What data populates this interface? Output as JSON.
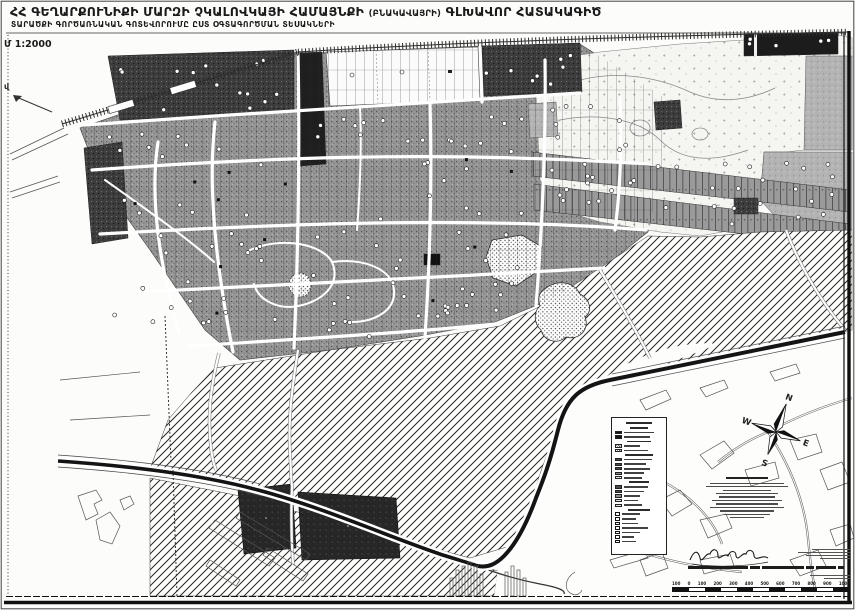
{
  "sheet": {
    "title_main": "ՀՀ ԳԵՂԱՐՔՈՒՆԻՔԻ ՄԱՐԶԻ ՉԿԱԼՈՎԿԱՅԻ ՀԱՄԱՅՆՔԻ",
    "title_paren": "(ԲՆԱԿԱՎԱՅՐԻ)",
    "title_tail": "ԳԼԽԱՎՈՐ ՀԱՏԱԿԱԳԻԾ",
    "subtitle": "ՏԱՐԱԾՔԻ ԳՈՐԾԱՌՆԱԿԱՆ ԳՈՏԵՎՈՐՈՒՄԸ ԸՍՏ ՕԳՏԱԳՈՐԾՄԱՆ ՏԵՍԱԿՆԵՐԻ",
    "scale_note": "Մ 1:2000",
    "edge_marker": "վ"
  },
  "compass": {
    "north": "N",
    "east": "E",
    "south": "S",
    "west": "W"
  },
  "legend": {
    "items": [
      {
        "k": "head",
        "lw": 26
      },
      {
        "k": "head",
        "lw": 18
      },
      {
        "k": "row",
        "s": "black",
        "lw": 30
      },
      {
        "k": "row",
        "s": "black",
        "lw": 26
      },
      {
        "k": "head",
        "lw": 24
      },
      {
        "k": "row",
        "s": "hatch",
        "lw": 16
      },
      {
        "k": "row",
        "s": "hatch",
        "lw": 24
      },
      {
        "k": "head",
        "lw": 28
      },
      {
        "k": "row",
        "s": "dark",
        "lw": 28
      },
      {
        "k": "row",
        "s": "dark",
        "lw": 22
      },
      {
        "k": "row",
        "s": "dark",
        "lw": 26
      },
      {
        "k": "row",
        "s": "gray",
        "lw": 20
      },
      {
        "k": "row",
        "s": "dots",
        "lw": 18
      },
      {
        "k": "head",
        "lw": 20
      },
      {
        "k": "row",
        "s": "dark",
        "lw": 24
      },
      {
        "k": "row",
        "s": "dark",
        "lw": 20
      },
      {
        "k": "row",
        "s": "gray",
        "lw": 16
      },
      {
        "k": "row",
        "s": "light",
        "lw": 14
      },
      {
        "k": "row",
        "s": "light",
        "lw": 18
      },
      {
        "k": "head",
        "lw": 22
      },
      {
        "k": "icon",
        "lw": 18
      },
      {
        "k": "icon",
        "lw": 14
      },
      {
        "k": "icon",
        "lw": 16
      },
      {
        "k": "icon",
        "lw": 26
      },
      {
        "k": "icon",
        "lw": 18
      },
      {
        "k": "icon",
        "lw": 12
      },
      {
        "k": "icon",
        "lw": 14
      }
    ]
  },
  "notes": {
    "heading_w": 42,
    "line_widths": [
      74,
      82,
      48,
      62,
      56,
      70,
      62,
      74,
      54,
      46,
      34
    ]
  },
  "side_text": {
    "line_widths": [
      38,
      52,
      44,
      30
    ],
    "line_widths2": [
      40,
      26
    ]
  },
  "caption": {
    "segments": [
      60,
      10,
      42,
      8,
      20,
      6
    ]
  },
  "scalebar": {
    "labels": [
      "100",
      "0",
      "100",
      "200",
      "300",
      "400",
      "500",
      "600",
      "700",
      "800",
      "900",
      "1000"
    ]
  },
  "colors": {
    "ink": "#1a1a1a",
    "paper": "#fcfcfa",
    "fabric_gray": "#969696",
    "dark_block": "#3d3d3d",
    "field_black": "#262626"
  }
}
